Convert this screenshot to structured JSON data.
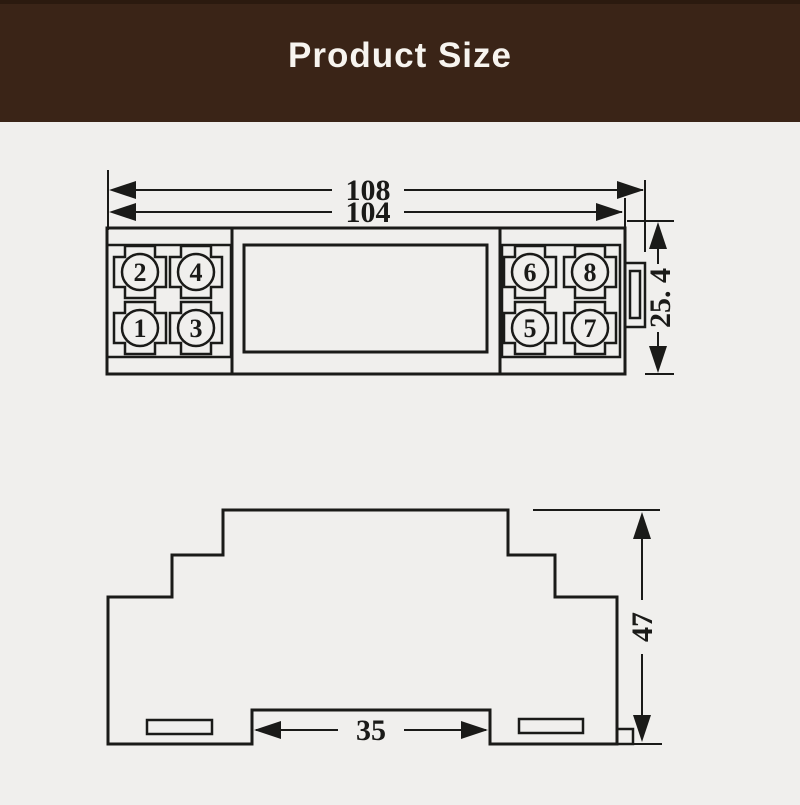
{
  "header": {
    "title": "Product Size"
  },
  "top_view": {
    "dims": {
      "overall_width": "108",
      "body_width": "104",
      "depth": "25. 4"
    },
    "terminals": [
      {
        "label": "2"
      },
      {
        "label": "4"
      },
      {
        "label": "1"
      },
      {
        "label": "3"
      },
      {
        "label": "6"
      },
      {
        "label": "8"
      },
      {
        "label": "5"
      },
      {
        "label": "7"
      }
    ]
  },
  "side_view": {
    "dims": {
      "height": "47",
      "din_slot_width": "35"
    }
  },
  "colors": {
    "header_bg": "#3a2417",
    "title_text": "#f7f4ef",
    "background": "#f0efed",
    "line": "#1a1a18"
  }
}
